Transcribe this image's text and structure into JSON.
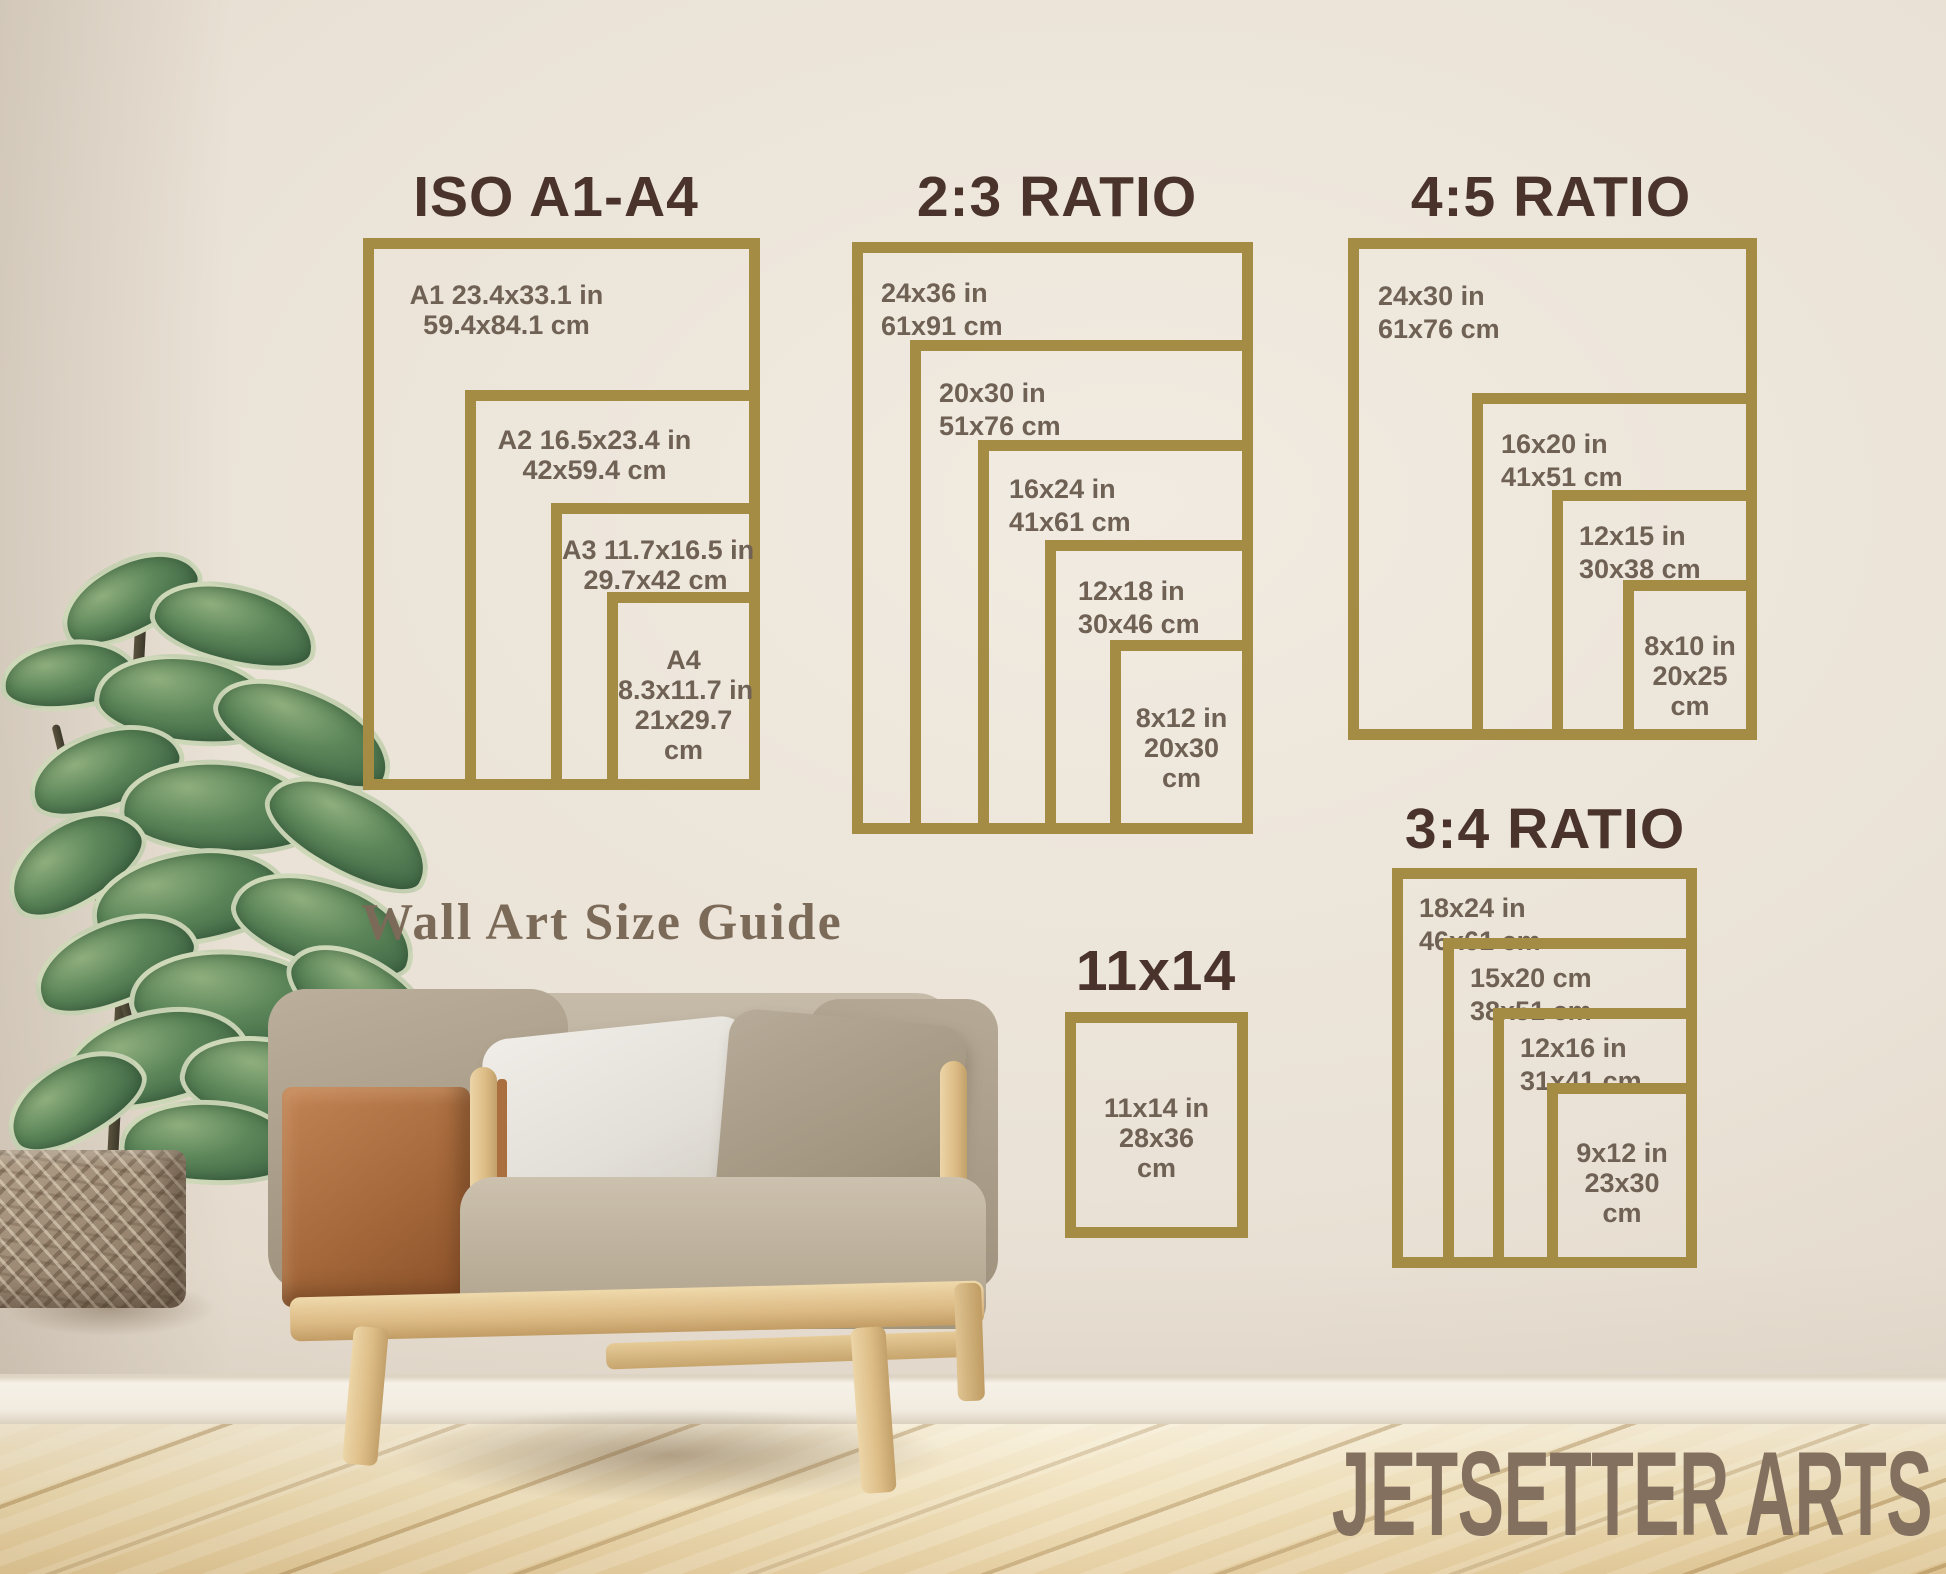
{
  "caption": "Wall Art Size Guide",
  "watermark": "JETSETTER ARTS",
  "colors": {
    "frame_gold": "#a58c44",
    "title_brown": "#4a332a",
    "label_taupe": "#6f6154",
    "caption_brown": "#7b6a58",
    "watermark_brown": "#84705f",
    "wall_beige": "#eae2d6",
    "floor_wood": "#eeddb4"
  },
  "groups": [
    {
      "title": "ISO A1-A4",
      "boxes": [
        {
          "name": "A1",
          "lines": [
            "A1 23.4x33.1 in",
            "59.4x84.1 cm"
          ]
        },
        {
          "name": "A2",
          "lines": [
            "A2 16.5x23.4 in",
            "42x59.4 cm"
          ]
        },
        {
          "name": "A3",
          "lines": [
            "A3 11.7x16.5 in",
            "29.7x42 cm"
          ]
        },
        {
          "name": "A4",
          "lines": [
            "A4",
            "8.3x11.7 in",
            "21x29.7",
            "cm"
          ]
        }
      ]
    },
    {
      "title": "2:3 RATIO",
      "boxes": [
        {
          "name": "24x36",
          "lines": [
            "24x36 in",
            "61x91 cm"
          ]
        },
        {
          "name": "20x30",
          "lines": [
            "20x30 in",
            "51x76 cm"
          ]
        },
        {
          "name": "16x24",
          "lines": [
            "16x24 in",
            "41x61 cm"
          ]
        },
        {
          "name": "12x18",
          "lines": [
            "12x18 in",
            "30x46 cm"
          ]
        },
        {
          "name": "8x12",
          "lines": [
            "8x12 in",
            "20x30",
            "cm"
          ]
        }
      ]
    },
    {
      "title": "4:5 RATIO",
      "boxes": [
        {
          "name": "24x30",
          "lines": [
            "24x30 in",
            "61x76 cm"
          ]
        },
        {
          "name": "16x20",
          "lines": [
            "16x20 in",
            "41x51 cm"
          ]
        },
        {
          "name": "12x15",
          "lines": [
            "12x15 in",
            "30x38 cm"
          ]
        },
        {
          "name": "8x10",
          "lines": [
            "8x10 in",
            "20x25",
            "cm"
          ]
        }
      ]
    },
    {
      "title": "3:4 RATIO",
      "boxes": [
        {
          "name": "18x24",
          "lines": [
            "18x24 in",
            "46x61 cm"
          ]
        },
        {
          "name": "15x20",
          "lines": [
            "15x20 cm",
            "38x51 cm"
          ]
        },
        {
          "name": "12x16",
          "lines": [
            "12x16 in",
            "31x41 cm"
          ]
        },
        {
          "name": "9x12",
          "lines": [
            "9x12 in",
            "23x30",
            "cm"
          ]
        }
      ]
    },
    {
      "title": "11x14",
      "boxes": [
        {
          "name": "11x14",
          "lines": [
            "11x14 in",
            "28x36",
            "cm"
          ]
        }
      ]
    }
  ]
}
